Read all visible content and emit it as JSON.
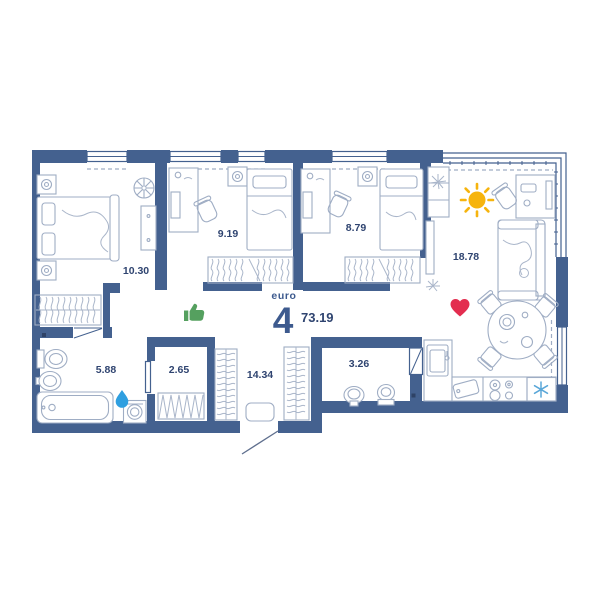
{
  "floor_plan": {
    "unit_label": {
      "prefix": "euro",
      "rooms_count": "4",
      "total_area": "73.19"
    },
    "rooms": [
      {
        "name": "bedroom-1",
        "area": "10.30"
      },
      {
        "name": "bedroom-2",
        "area": "9.19"
      },
      {
        "name": "bedroom-3",
        "area": "8.79"
      },
      {
        "name": "living-kitchen",
        "area": "18.78"
      },
      {
        "name": "bathroom",
        "area": "5.88"
      },
      {
        "name": "storage",
        "area": "2.65"
      },
      {
        "name": "hallway",
        "area": "14.34"
      },
      {
        "name": "wc",
        "area": "3.26"
      }
    ],
    "icons": [
      {
        "name": "thumbs-up-icon",
        "color": "#55a05f"
      },
      {
        "name": "sun-icon",
        "color": "#f6b40e"
      },
      {
        "name": "heart-icon",
        "color": "#e32d4f"
      },
      {
        "name": "water-drop-icon",
        "color": "#2f9fe0"
      },
      {
        "name": "snowflake-icon",
        "color": "#5aa7d8"
      }
    ],
    "colors": {
      "wall": "#44618f",
      "furniture_line": "#9fadc4",
      "label_text": "#2f4470"
    }
  }
}
